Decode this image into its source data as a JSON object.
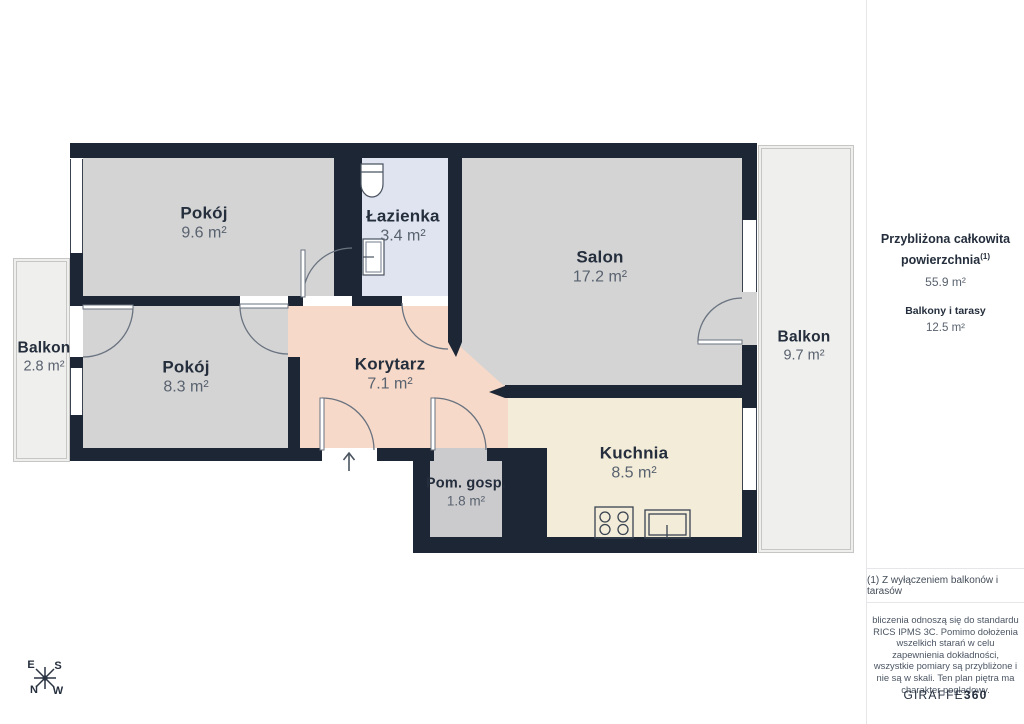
{
  "rooms": {
    "pokoj_a": {
      "name": "Pokój",
      "area": "9.6 m²"
    },
    "lazienka": {
      "name": "Łazienka",
      "area": "3.4 m²"
    },
    "salon": {
      "name": "Salon",
      "area": "17.2 m²"
    },
    "pokoj_b": {
      "name": "Pokój",
      "area": "8.3 m²"
    },
    "korytarz": {
      "name": "Korytarz",
      "area": "7.1 m²"
    },
    "kuchnia": {
      "name": "Kuchnia",
      "area": "8.5 m²"
    },
    "pom_gosp": {
      "name": "Pom. gosp.",
      "area": "1.8 m²"
    },
    "balkon_left": {
      "name": "Balkon",
      "area": "2.8 m²"
    },
    "balkon_right": {
      "name": "Balkon",
      "area": "9.7 m²"
    }
  },
  "sidebar": {
    "total_label": "Przybliżona całkowita powierzchnia",
    "total_footnote_marker": "(1)",
    "total_value": "55.9 m²",
    "balconies_label": "Balkony i tarasy",
    "balconies_value": "12.5 m²",
    "footnote": "(1) Z wyłączeniem balkonów i tarasów",
    "disclaimer": "bliczenia odnoszą się do standardu RICS IPMS 3C. Pomimo dołożenia wszelkich starań w celu zapewnienia dokładności, wszystkie pomiary są przybliżone i nie są w skali. Ten plan piętra ma charakter poglądowy.",
    "logo_main": "GIRAFFE",
    "logo_suffix": "360"
  },
  "compass": {
    "top_left": "E",
    "top_right": "S",
    "bottom_left": "N",
    "bottom_right": "W"
  },
  "colors": {
    "wall": "#1d2634",
    "room_gray": "#d4d4d4",
    "bathroom_blue": "#dfe4f0",
    "corridor_peach": "#f6d9c8",
    "kitchen_cream": "#f3ecd9",
    "utility_gray": "#cbcbcd",
    "balcony_gray": "#efefed",
    "text_primary": "#242e3c",
    "text_secondary": "#59626f"
  }
}
